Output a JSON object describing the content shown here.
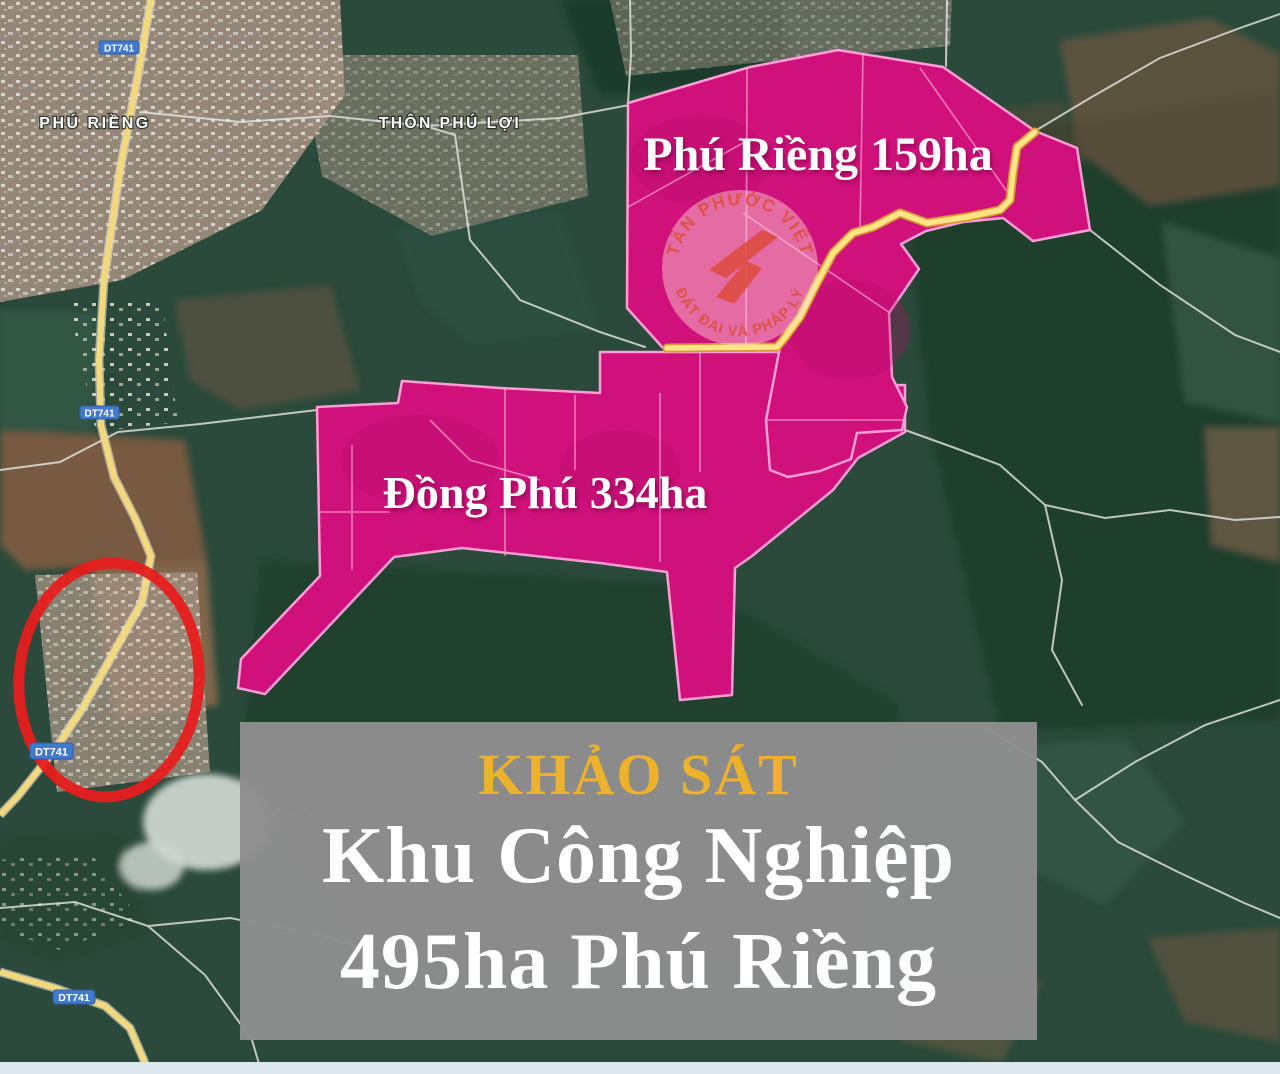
{
  "colors": {
    "zone_fill": "#d0117c",
    "zone_stroke": "#ff9fd6",
    "route_yellow": "#ffe487",
    "dt741_road_yellow": "#f3d97e",
    "red_circle": "#e61e1e",
    "badge_blue": "#4179cf",
    "caption_bg": "#8d8d8d",
    "caption_title_gold": "#ecb22c",
    "caption_text_white": "#ffffff",
    "watermark_red": "#dd4f41"
  },
  "map": {
    "place_labels": [
      {
        "id": "phu-rieng-town",
        "text": "PHÚ RIỀNG"
      },
      {
        "id": "thon-phu-loi",
        "text": "THÔN PHÚ LỢI"
      }
    ],
    "road_badges": [
      {
        "text": "DT741"
      },
      {
        "text": "DT741"
      },
      {
        "text": "DT741"
      },
      {
        "text": "DT741"
      }
    ],
    "zones": [
      {
        "id": "phu-rieng-159",
        "label": "Phú Riềng 159ha"
      },
      {
        "id": "dong-phu-334",
        "label": "Đồng Phú 334ha"
      }
    ]
  },
  "watermark": {
    "arc_top": "TÂN PHƯỚC VIỆT",
    "arc_bottom": "ĐẤT ĐAI VÀ PHÁP LÝ"
  },
  "caption": {
    "title": "KHẢO SÁT",
    "line1": "Khu Công Nghiệp",
    "line2": "495ha Phú Riềng"
  }
}
